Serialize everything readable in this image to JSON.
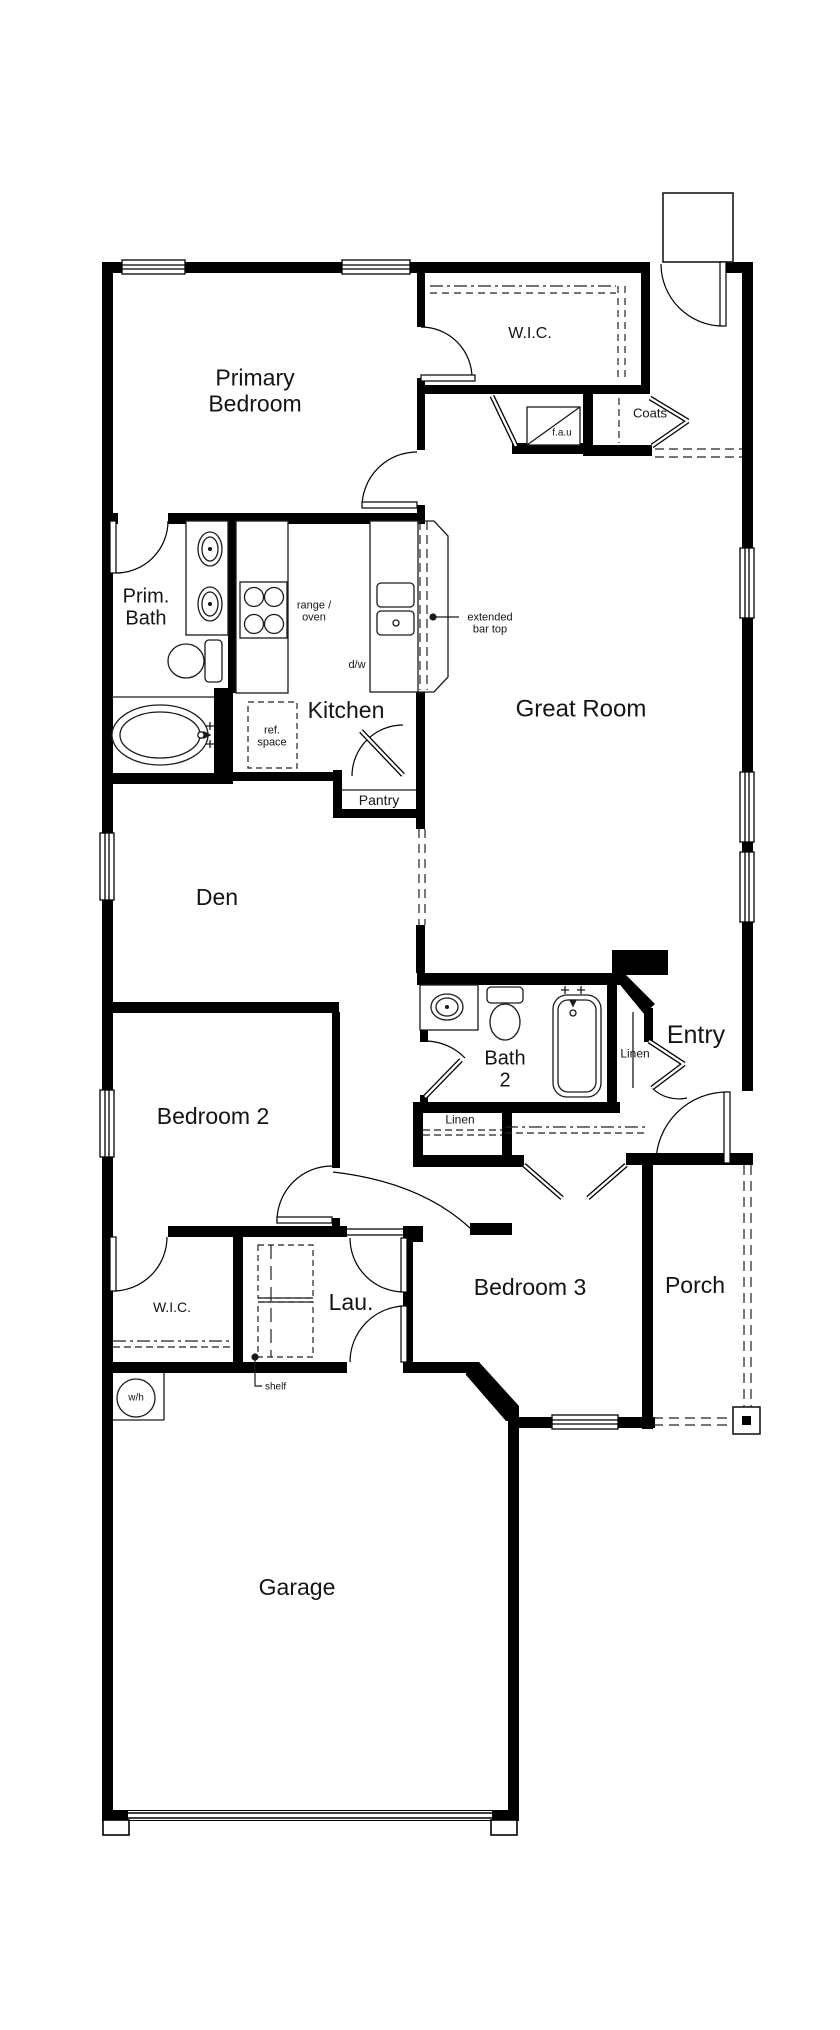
{
  "meta": {
    "title": "Single-story house floor plan",
    "colors": {
      "wall": "#000000",
      "background": "#ffffff",
      "text": "#141414"
    }
  },
  "labels": {
    "primary_bedroom": {
      "text": "Primary\nBedroom"
    },
    "wic_primary": {
      "text": "W.I.C."
    },
    "coats": {
      "text": "Coats"
    },
    "fau": {
      "text": "f.a.u"
    },
    "prim_bath": {
      "text": "Prim.\nBath"
    },
    "range_oven": {
      "text": "range /\noven"
    },
    "extended_bar": {
      "text": "extended\nbar top"
    },
    "dw": {
      "text": "d/w"
    },
    "kitchen": {
      "text": "Kitchen"
    },
    "great_room": {
      "text": "Great Room"
    },
    "ref_space": {
      "text": "ref.\nspace"
    },
    "pantry": {
      "text": "Pantry"
    },
    "den": {
      "text": "Den"
    },
    "bath2": {
      "text": "Bath\n2"
    },
    "linen_upper": {
      "text": "Linen"
    },
    "entry": {
      "text": "Entry"
    },
    "linen_lower": {
      "text": "Linen"
    },
    "bedroom2": {
      "text": "Bedroom 2"
    },
    "wic2": {
      "text": "W.I.C."
    },
    "lau": {
      "text": "Lau."
    },
    "bedroom3": {
      "text": "Bedroom 3"
    },
    "porch": {
      "text": "Porch"
    },
    "shelf": {
      "text": "shelf"
    },
    "wh": {
      "text": "w/h"
    },
    "garage": {
      "text": "Garage"
    }
  },
  "fixtures": [
    "double-vanity-sinks",
    "toilet",
    "oval-bathtub",
    "range-oven-burners",
    "double-basin-kitchen-sink",
    "dishwasher",
    "refrigerator-space",
    "forced-air-unit",
    "washer-dryer-space",
    "water-heater",
    "bathtub",
    "vanity-sink",
    "porch-post",
    "entry-stoop"
  ]
}
